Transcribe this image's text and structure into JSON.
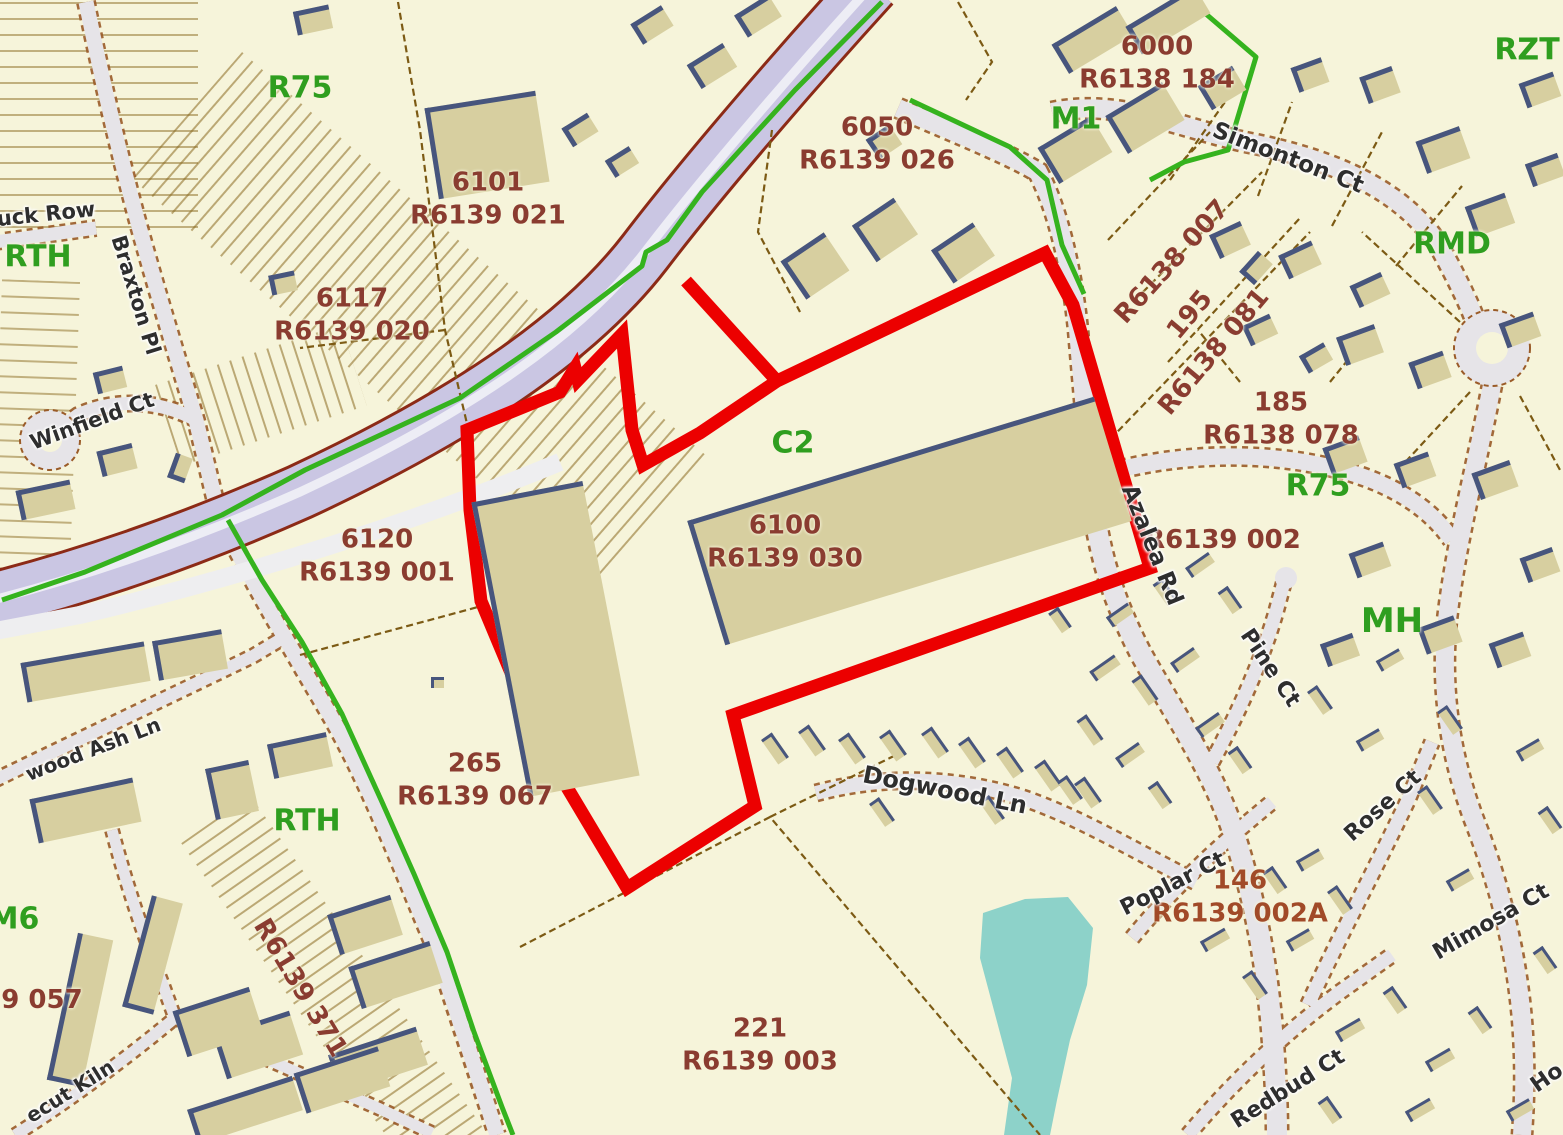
{
  "map": {
    "colors": {
      "background": "#f6f4da",
      "selection_outline": "#ec0000",
      "zoning_text": "#2f9e1f",
      "parcel_text": "#8a3c30",
      "parcel_text_alt": "#a14a28",
      "street_text": "#2e2e2e",
      "highway_fill": "#cac6e3",
      "road_fill": "#e6e4e8",
      "building_fill": "#d7cfa0",
      "building_edge": "#47557d",
      "water": "#8dd2c9",
      "zone_boundary_green": "#35b31e",
      "parcel_line": "#7c5a14"
    },
    "zoning_labels": [
      {
        "text": "R75",
        "x": 300,
        "y": 88,
        "size": 30
      },
      {
        "text": "RTH",
        "x": 38,
        "y": 257,
        "size": 30
      },
      {
        "text": "M1",
        "x": 1076,
        "y": 119,
        "size": 30
      },
      {
        "text": "RZT",
        "x": 1527,
        "y": 50,
        "size": 30
      },
      {
        "text": "RMD",
        "x": 1452,
        "y": 244,
        "size": 30
      },
      {
        "text": "C2",
        "x": 793,
        "y": 443,
        "size": 30
      },
      {
        "text": "R75",
        "x": 1318,
        "y": 486,
        "size": 30
      },
      {
        "text": "MH",
        "x": 1392,
        "y": 621,
        "size": 34
      },
      {
        "text": "RTH",
        "x": 307,
        "y": 821,
        "size": 30
      },
      {
        "text": "M6",
        "x": 14,
        "y": 919,
        "size": 30
      }
    ],
    "parcel_labels": [
      {
        "lines": [
          "6101",
          "R6139 021"
        ],
        "x": 488,
        "y": 199,
        "rot": 0
      },
      {
        "lines": [
          "6117",
          "R6139 020"
        ],
        "x": 352,
        "y": 315,
        "rot": 0
      },
      {
        "lines": [
          "6050",
          "R6139 026"
        ],
        "x": 877,
        "y": 144,
        "rot": 0
      },
      {
        "lines": [
          "6000",
          "R6138 184"
        ],
        "x": 1157,
        "y": 63,
        "rot": 0
      },
      {
        "lines": [
          "6100",
          "R6139 030"
        ],
        "x": 785,
        "y": 542,
        "rot": 0
      },
      {
        "lines": [
          "6120",
          "R6139 001"
        ],
        "x": 377,
        "y": 556,
        "rot": 0
      },
      {
        "lines": [
          "265",
          "R6139 067"
        ],
        "x": 475,
        "y": 780,
        "rot": 0
      },
      {
        "lines": [
          "221",
          "R6139 003"
        ],
        "x": 760,
        "y": 1045,
        "rot": 0
      },
      {
        "lines": [
          "185",
          "R6138 078"
        ],
        "x": 1281,
        "y": 419,
        "rot": 0
      },
      {
        "lines": [
          "146",
          "R6139 002A"
        ],
        "x": 1240,
        "y": 897,
        "rot": 0,
        "alt": true
      },
      {
        "lines": [
          "R6139 002"
        ],
        "x": 1223,
        "y": 540,
        "rot": 0
      },
      {
        "lines": [
          "R6138 007"
        ],
        "x": 1172,
        "y": 262,
        "rot": -48
      },
      {
        "lines": [
          "195"
        ],
        "x": 1190,
        "y": 315,
        "rot": -50
      },
      {
        "lines": [
          "R6138 081"
        ],
        "x": 1214,
        "y": 352,
        "rot": -50
      },
      {
        "lines": [
          "R6139 371"
        ],
        "x": 300,
        "y": 988,
        "rot": 59
      },
      {
        "lines": [
          "9 057"
        ],
        "x": 42,
        "y": 1000,
        "rot": 0
      }
    ],
    "street_labels": [
      {
        "text": "uck Row",
        "x": 46,
        "y": 214,
        "rot": -6,
        "size": 21
      },
      {
        "text": "Braxton Pl",
        "x": 136,
        "y": 295,
        "rot": 73,
        "size": 21
      },
      {
        "text": "Winfield Ct",
        "x": 92,
        "y": 421,
        "rot": -20,
        "size": 21
      },
      {
        "text": "Simonton Ct",
        "x": 1288,
        "y": 158,
        "rot": 21,
        "size": 23
      },
      {
        "text": "Azalea Rd",
        "x": 1152,
        "y": 545,
        "rot": 68,
        "size": 23
      },
      {
        "text": "Pine Ct",
        "x": 1270,
        "y": 668,
        "rot": 56,
        "size": 22
      },
      {
        "text": "Dogwood Ln",
        "x": 945,
        "y": 790,
        "rot": 11,
        "size": 24
      },
      {
        "text": "Poplar Ct",
        "x": 1173,
        "y": 884,
        "rot": -27,
        "size": 22
      },
      {
        "text": "Rose Ct",
        "x": 1383,
        "y": 806,
        "rot": -42,
        "size": 22
      },
      {
        "text": "Mimosa Ct",
        "x": 1491,
        "y": 922,
        "rot": -30,
        "size": 22
      },
      {
        "text": "Redbud Ct",
        "x": 1288,
        "y": 1089,
        "rot": -32,
        "size": 22
      },
      {
        "text": "Ho",
        "x": 1547,
        "y": 1078,
        "rot": -35,
        "size": 22
      },
      {
        "text": "wood Ash Ln",
        "x": 93,
        "y": 749,
        "rot": -21,
        "size": 20
      },
      {
        "text": "ecut Kiln",
        "x": 70,
        "y": 1091,
        "rot": -32,
        "size": 20
      }
    ],
    "buildings": [
      [
        487,
        145,
        112,
        92,
        -9
      ],
      [
        313,
        20,
        36,
        24,
        -12
      ],
      [
        283,
        283,
        26,
        20,
        -12
      ],
      [
        110,
        380,
        30,
        22,
        -14
      ],
      [
        117,
        460,
        36,
        26,
        -14
      ],
      [
        45,
        500,
        55,
        30,
        -12
      ],
      [
        180,
        468,
        26,
        18,
        -70
      ],
      [
        437,
        682,
        13,
        11,
        0
      ],
      [
        652,
        25,
        36,
        24,
        -32
      ],
      [
        712,
        66,
        42,
        28,
        -32
      ],
      [
        758,
        16,
        40,
        26,
        -32
      ],
      [
        580,
        130,
        30,
        22,
        -32
      ],
      [
        622,
        162,
        28,
        20,
        -32
      ],
      [
        885,
        230,
        50,
        44,
        -34
      ],
      [
        963,
        253,
        50,
        40,
        -34
      ],
      [
        815,
        266,
        52,
        46,
        -34
      ],
      [
        884,
        142,
        28,
        24,
        -34
      ],
      [
        1092,
        40,
        75,
        34,
        -31
      ],
      [
        1168,
        20,
        80,
        32,
        -31
      ],
      [
        1075,
        150,
        62,
        42,
        -31
      ],
      [
        1145,
        118,
        66,
        44,
        -31
      ],
      [
        1222,
        88,
        40,
        28,
        -31
      ],
      [
        1310,
        75,
        32,
        26,
        -20
      ],
      [
        1380,
        85,
        34,
        28,
        -20
      ],
      [
        1540,
        90,
        36,
        26,
        -20
      ],
      [
        1443,
        150,
        46,
        34,
        -20
      ],
      [
        1490,
        215,
        42,
        32,
        -20
      ],
      [
        1545,
        170,
        34,
        24,
        -20
      ],
      [
        1360,
        345,
        40,
        30,
        -20
      ],
      [
        1430,
        370,
        36,
        28,
        -20
      ],
      [
        1520,
        330,
        36,
        26,
        -20
      ],
      [
        1345,
        455,
        38,
        28,
        -20
      ],
      [
        1415,
        470,
        36,
        26,
        -20
      ],
      [
        1495,
        480,
        40,
        28,
        -20
      ],
      [
        1540,
        565,
        34,
        26,
        -20
      ],
      [
        1370,
        560,
        36,
        26,
        -20
      ],
      [
        1440,
        635,
        38,
        28,
        -20
      ],
      [
        1510,
        650,
        36,
        26,
        -20
      ],
      [
        1340,
        650,
        34,
        24,
        -20
      ],
      [
        1230,
        240,
        34,
        26,
        -25
      ],
      [
        1300,
        260,
        36,
        26,
        -25
      ],
      [
        1370,
        290,
        34,
        24,
        -25
      ],
      [
        1260,
        330,
        30,
        22,
        -25
      ],
      [
        1256,
        268,
        28,
        20,
        -48
      ],
      [
        1316,
        358,
        28,
        20,
        -30
      ],
      [
        909,
        521,
        425,
        130,
        -17
      ],
      [
        555,
        639,
        113,
        300,
        -11
      ],
      [
        775,
        748,
        30,
        13,
        55
      ],
      [
        812,
        740,
        30,
        13,
        55
      ],
      [
        852,
        748,
        30,
        13,
        55
      ],
      [
        893,
        745,
        30,
        13,
        55
      ],
      [
        935,
        742,
        30,
        13,
        55
      ],
      [
        972,
        752,
        30,
        13,
        55
      ],
      [
        1010,
        762,
        30,
        13,
        55
      ],
      [
        1048,
        775,
        30,
        13,
        55
      ],
      [
        1088,
        792,
        30,
        13,
        55
      ],
      [
        882,
        812,
        28,
        12,
        55
      ],
      [
        992,
        810,
        28,
        12,
        55
      ],
      [
        1105,
        668,
        30,
        12,
        -35
      ],
      [
        1145,
        690,
        30,
        12,
        55
      ],
      [
        1185,
        660,
        28,
        12,
        -35
      ],
      [
        1090,
        730,
        30,
        12,
        55
      ],
      [
        1130,
        755,
        28,
        12,
        -35
      ],
      [
        1070,
        790,
        28,
        12,
        55
      ],
      [
        1160,
        795,
        26,
        12,
        55
      ],
      [
        1210,
        725,
        28,
        12,
        -35
      ],
      [
        1240,
        760,
        26,
        12,
        55
      ],
      [
        1200,
        565,
        28,
        12,
        -35
      ],
      [
        1165,
        592,
        26,
        12,
        55
      ],
      [
        1230,
        600,
        26,
        12,
        55
      ],
      [
        1120,
        615,
        26,
        12,
        -35
      ],
      [
        1060,
        620,
        24,
        12,
        55
      ],
      [
        1215,
        940,
        28,
        12,
        -30
      ],
      [
        1255,
        985,
        28,
        12,
        55
      ],
      [
        1300,
        940,
        26,
        12,
        -30
      ],
      [
        1340,
        900,
        28,
        12,
        55
      ],
      [
        1310,
        860,
        26,
        12,
        -30
      ],
      [
        1275,
        880,
        26,
        12,
        55
      ],
      [
        1350,
        1030,
        28,
        12,
        -30
      ],
      [
        1395,
        1000,
        26,
        12,
        55
      ],
      [
        1440,
        1060,
        28,
        12,
        -30
      ],
      [
        1480,
        1020,
        26,
        12,
        55
      ],
      [
        1420,
        1110,
        28,
        12,
        -30
      ],
      [
        1330,
        1110,
        26,
        12,
        55
      ],
      [
        1520,
        1110,
        26,
        12,
        -30
      ],
      [
        1545,
        960,
        26,
        12,
        55
      ],
      [
        1460,
        880,
        26,
        12,
        -30
      ],
      [
        1430,
        800,
        28,
        12,
        55
      ],
      [
        1370,
        740,
        26,
        12,
        -30
      ],
      [
        1320,
        700,
        28,
        12,
        55
      ],
      [
        1390,
        660,
        26,
        12,
        -30
      ],
      [
        1450,
        720,
        28,
        12,
        55
      ],
      [
        1530,
        750,
        26,
        12,
        -30
      ],
      [
        1550,
        820,
        26,
        12,
        55
      ],
      [
        85,
        672,
        125,
        40,
        -10
      ],
      [
        190,
        655,
        70,
        40,
        -10
      ],
      [
        85,
        810,
        105,
        45,
        -12
      ],
      [
        232,
        790,
        44,
        52,
        -12
      ],
      [
        300,
        755,
        60,
        35,
        -12
      ],
      [
        80,
        1010,
        150,
        36,
        -78
      ],
      [
        152,
        955,
        115,
        32,
        -75
      ],
      [
        245,
        1110,
        110,
        36,
        -18
      ],
      [
        378,
        1060,
        92,
        40,
        -18
      ],
      [
        258,
        1045,
        80,
        46,
        -18
      ],
      [
        395,
        975,
        85,
        44,
        -18
      ],
      [
        365,
        925,
        66,
        42,
        -18
      ],
      [
        218,
        1022,
        80,
        48,
        -18
      ],
      [
        342,
        1080,
        88,
        42,
        -18
      ]
    ]
  }
}
